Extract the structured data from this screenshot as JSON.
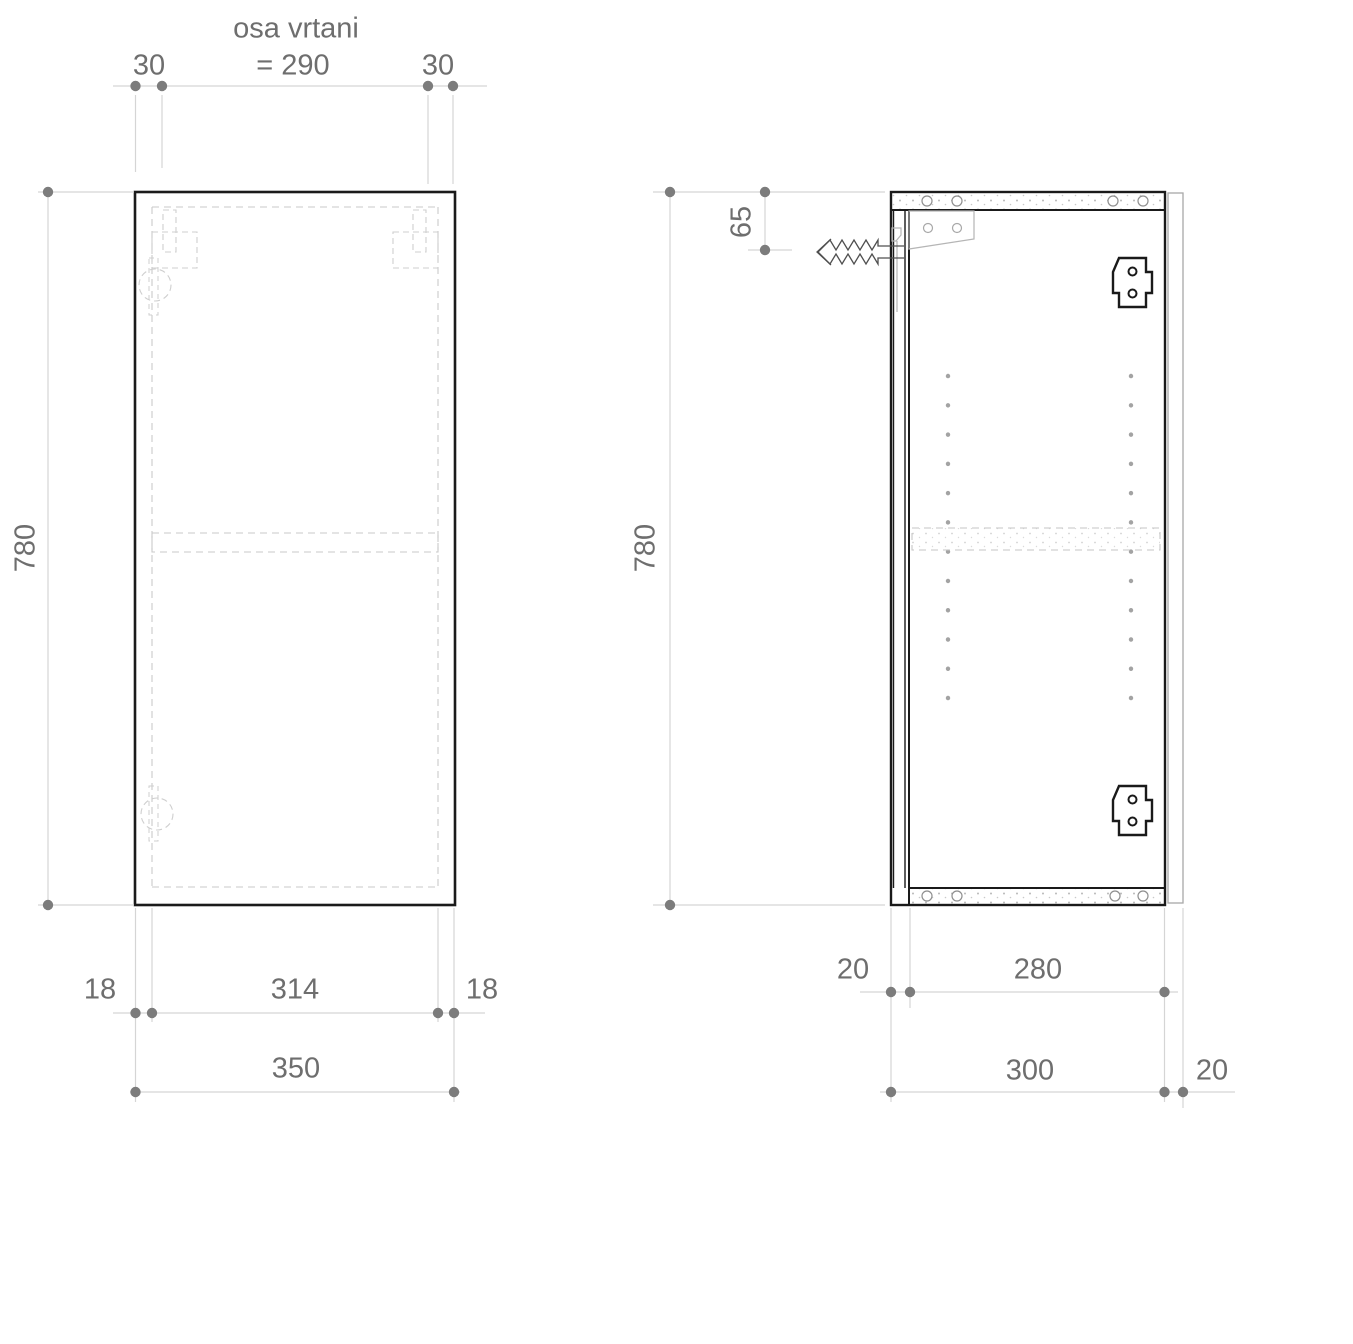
{
  "annotation": {
    "line1": "osa vrtani",
    "line2": "= 290"
  },
  "front_view": {
    "top": {
      "left_offset": "30",
      "right_offset": "30"
    },
    "height": "780",
    "bottom": {
      "left_panel": "18",
      "inner_width": "314",
      "right_panel": "18",
      "total_width": "350"
    }
  },
  "side_view": {
    "height": "780",
    "hanger_offset": "65",
    "bottom": {
      "front": "20",
      "inner_depth": "280",
      "total_depth": "300",
      "back": "20"
    }
  },
  "colors": {
    "outline": "#1a1a1a",
    "dashed_line": "#c9c9c9",
    "dimension_line": "#d5d5d5",
    "dimension_dot": "#7c7c7c",
    "dimension_text": "#6e6e6e",
    "hardware_gray": "#b5b5b5"
  }
}
